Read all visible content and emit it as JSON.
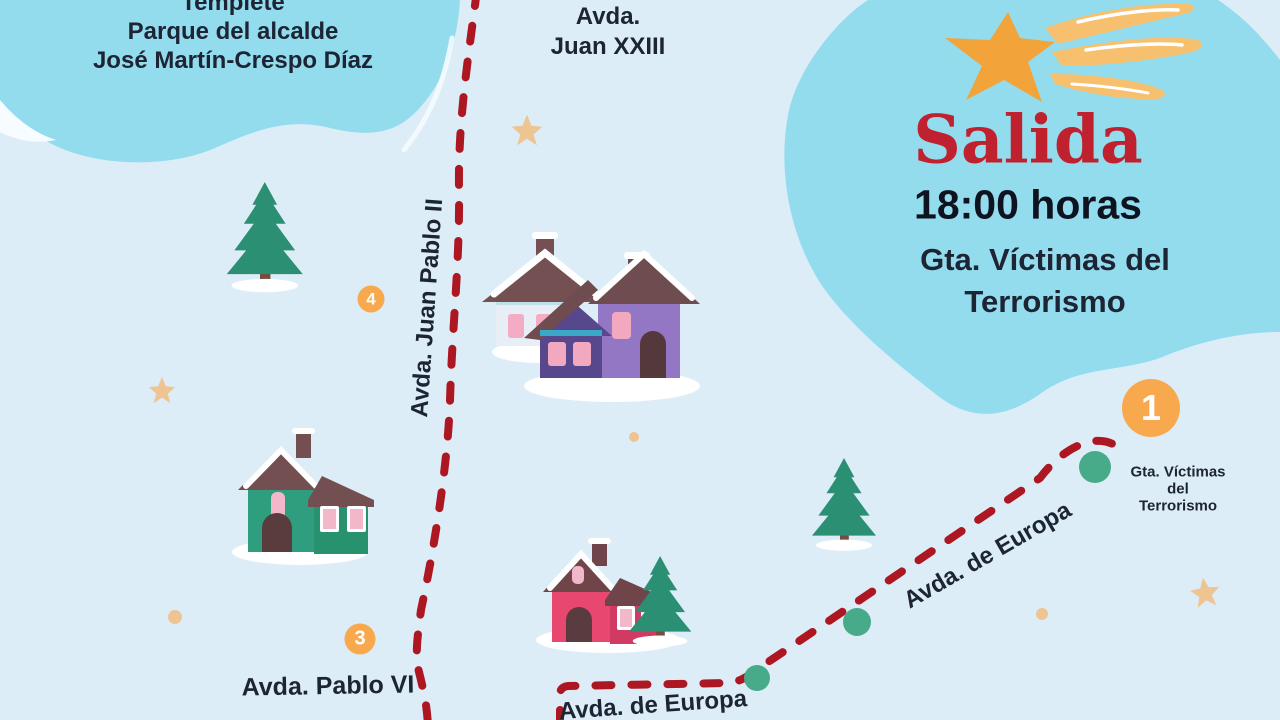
{
  "map": {
    "park_label": {
      "line1": "Templete",
      "line2": "Parque del alcalde",
      "line3": "José Martín-Crespo Díaz"
    },
    "streets": {
      "juan_xxiii_line1": "Avda.",
      "juan_xxiii_line2": "Juan XXIII",
      "juan_pablo_ii": "Avda. Juan Pablo II",
      "pablo_vi": "Avda. Pablo VI",
      "europa_upper": "Avda. de Europa",
      "europa_lower": "Avda. de Europa"
    },
    "start_panel": {
      "title": "Salida",
      "time": "18:00 horas",
      "location_line1": "Gta. Víctimas del",
      "location_line2": "Terrorismo"
    },
    "roundabout_label": {
      "line1": "Gta. Víctimas",
      "line2": "del",
      "line3": "Terrorismo"
    },
    "markers": [
      {
        "number": "1"
      },
      {
        "number": "3"
      },
      {
        "number": "4"
      }
    ],
    "colors": {
      "background": "#dcedf8",
      "blob_blue": "#93dcee",
      "route_red": "#ad1722",
      "marker_orange": "#f8a94e",
      "stop_green": "#47aa88",
      "title_red": "#bf222e",
      "text_dark": "#1d2433",
      "star_tan": "#efc493",
      "shooting_star_orange": "#f2a43b",
      "tree_green": "#2b8f74"
    },
    "icons": {
      "shooting_star": "shooting-star-icon",
      "pine_tree": "pine-tree-icon",
      "cottage": "house-icon",
      "route": "dashed-route-line",
      "stop_dot": "route-stop-dot",
      "sparkle_star": "star-icon"
    }
  }
}
